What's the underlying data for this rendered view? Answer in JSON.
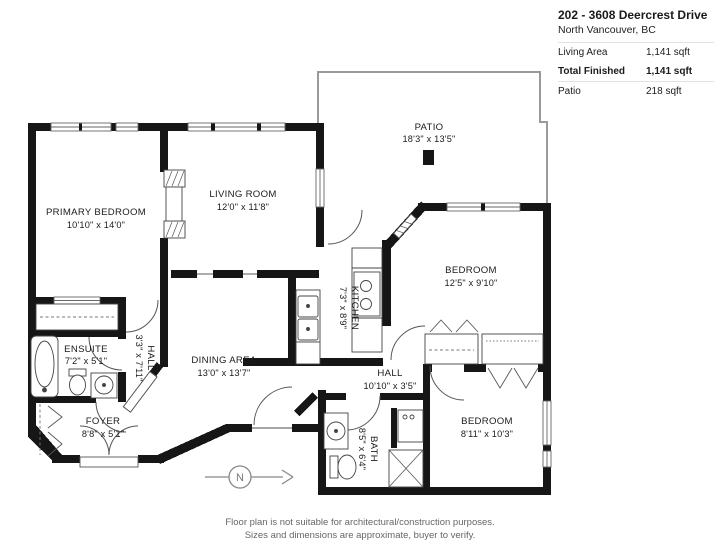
{
  "header": {
    "title": "202 - 3608 Deercrest Drive",
    "location": "North Vancouver, BC",
    "stats": [
      {
        "label": "Living Area",
        "value": "1,141 sqft"
      },
      {
        "label": "Total Finished",
        "value": "1,141 sqft"
      },
      {
        "label": "Patio",
        "value": "218 sqft"
      }
    ]
  },
  "plan": {
    "rooms": {
      "patio": {
        "name": "PATIO",
        "dims": "18'3\" x 13'5\""
      },
      "primary_bedroom": {
        "name": "PRIMARY BEDROOM",
        "dims": "10'10\" x 14'0\""
      },
      "living_room": {
        "name": "LIVING ROOM",
        "dims": "12'0\" x 11'8\""
      },
      "bedroom_right": {
        "name": "BEDROOM",
        "dims": "12'5\" x 9'10\""
      },
      "kitchen": {
        "name": "KITCHEN",
        "dims": "7'3\" x 8'9\""
      },
      "dining_area": {
        "name": "DINING AREA",
        "dims": "13'0\" x 13'7\""
      },
      "hall_small": {
        "name": "HALL",
        "dims": "3'3\" x 7'11\""
      },
      "ensuite": {
        "name": "ENSUITE",
        "dims": "7'2\" x 5'1\""
      },
      "hall_main": {
        "name": "HALL",
        "dims": "10'10\" x 3'5\""
      },
      "foyer": {
        "name": "FOYER",
        "dims": "8'8\" x 5'1\""
      },
      "bath": {
        "name": "BATH",
        "dims": "8'5\" x 6'4\""
      },
      "bedroom_bottom": {
        "name": "BEDROOM",
        "dims": "8'11\" x 10'3\""
      }
    },
    "compass": {
      "label": "N"
    }
  },
  "footer": {
    "line1": "Floor plan is not suitable for architectural/construction purposes.",
    "line2": "Sizes and dimensions are approximate, buyer to verify."
  }
}
